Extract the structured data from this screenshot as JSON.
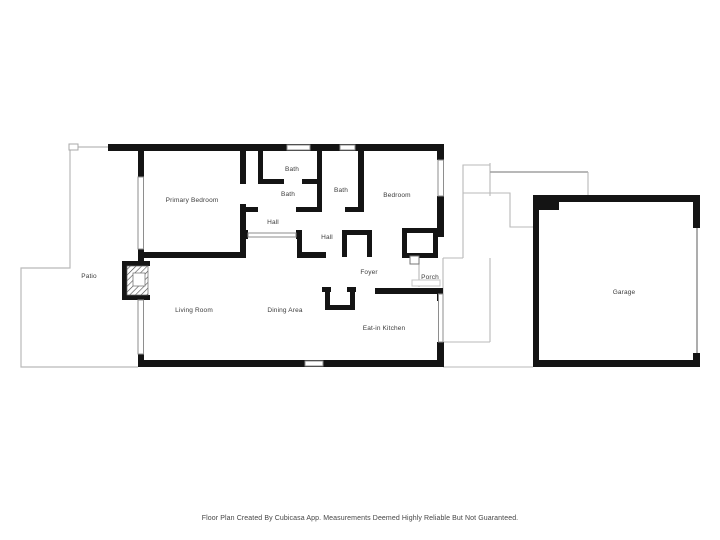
{
  "rooms": [
    {
      "id": "primary-bedroom",
      "label": "Primary Bedroom"
    },
    {
      "id": "bath-1",
      "label": "Bath"
    },
    {
      "id": "bath-2",
      "label": "Bath"
    },
    {
      "id": "bath-3",
      "label": "Bath"
    },
    {
      "id": "bedroom",
      "label": "Bedroom"
    },
    {
      "id": "hall-1",
      "label": "Hall"
    },
    {
      "id": "hall-2",
      "label": "Hall"
    },
    {
      "id": "patio",
      "label": "Patio"
    },
    {
      "id": "foyer",
      "label": "Foyer"
    },
    {
      "id": "porch",
      "label": "Porch"
    },
    {
      "id": "living-room",
      "label": "Living Room"
    },
    {
      "id": "dining-area",
      "label": "Dining Area"
    },
    {
      "id": "eat-in-kitchen",
      "label": "Eat-in Kitchen"
    },
    {
      "id": "garage",
      "label": "Garage"
    }
  ],
  "footer": {
    "disclaimer": "Floor Plan Created By Cubicasa App. Measurements Deemed Highly Reliable But Not Guaranteed."
  },
  "colors": {
    "wall": "#141414",
    "thin_line": "#b9b9b9",
    "window_stroke": "#8e8e8e",
    "label_text": "#3c3c3c",
    "background": "#ffffff"
  }
}
